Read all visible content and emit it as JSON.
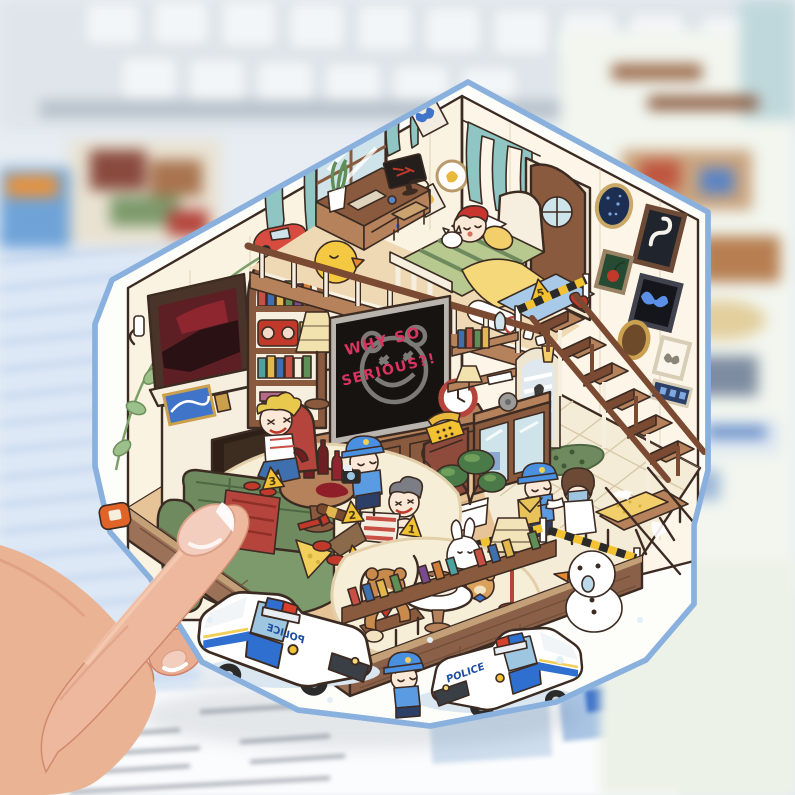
{
  "photo": {
    "background": {
      "keyboard_key_color": "#f3f6f8",
      "desk_left_color": "#dce8f4",
      "stripe_color": "#c3d6ee",
      "desk_right_color": "#f2f6ef",
      "paper_color": "#fbfcfd",
      "paper_line_color": "#a7adb6"
    },
    "hand": {
      "skin": "#eeb89e",
      "skin_shadow": "#d08a6e",
      "nail": "#f3cdbd",
      "nail_tip": "#ffffff"
    }
  },
  "sticker": {
    "outline_color": "#8ab1de",
    "wall_color": "#fbf3e2",
    "wood_color": "#b5825c",
    "dark_wood": "#7b4a32",
    "curtain_teal": "#8fc6c4",
    "police_blue": "#2f6fd0",
    "cap_blue": "#4a90e0",
    "tape_yellow": "#f2c232",
    "sofa_green": "#6f8a5e",
    "fire_orange": "#f59b2c",
    "tv_screen_color": "#171311",
    "graffiti_red": "#d9345f",
    "tv": {
      "graffiti_line1": "WHY SO",
      "graffiti_line2": "SERIOUS?!"
    },
    "police_car": {
      "label": "POLICE"
    },
    "evidence_markers": {
      "m1": "1",
      "m2": "2",
      "m3": "3",
      "m4": "4",
      "m5": "5"
    }
  }
}
